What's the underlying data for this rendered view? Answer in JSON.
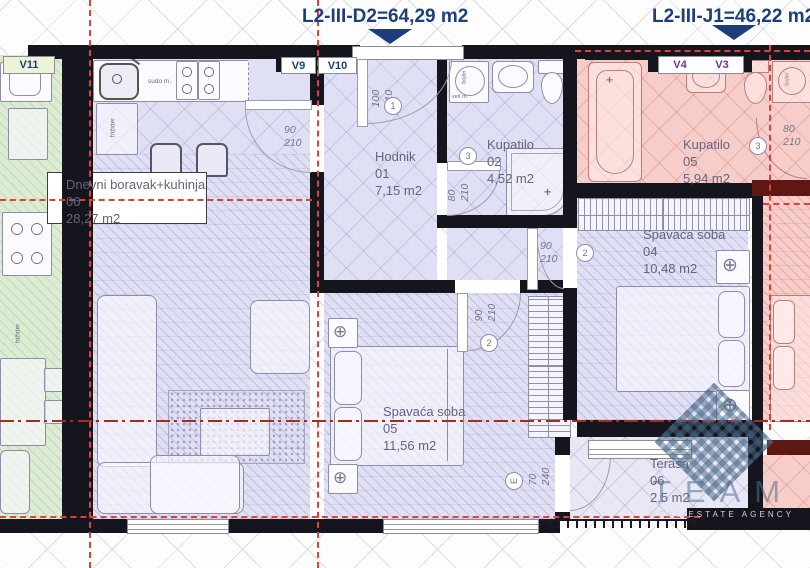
{
  "header": {
    "left_unit": "L2-III-D2=64,29 m2",
    "right_unit": "L2-III-J1=46,22 m2"
  },
  "vents": {
    "v11": "V11",
    "v9": "V9",
    "v10": "V10",
    "v4": "V4",
    "v3": "V3"
  },
  "rooms": {
    "living": {
      "name": "Dnevni boravak+kuhinja",
      "num": "06",
      "area": "28,27 m2"
    },
    "hallway": {
      "name": "Hodnik",
      "num": "01",
      "area": "7,15 m2"
    },
    "bath1": {
      "name": "Kupatilo",
      "num": "02",
      "area": "4,52 m2"
    },
    "bath2": {
      "name": "Kupatilo",
      "num": "05",
      "area": "5,94 m2"
    },
    "bedroom1": {
      "name": "Spavaća soba",
      "num": "04",
      "area": "10,48 m2"
    },
    "bedroom2": {
      "name": "Spavaća soba",
      "num": "05",
      "area": "11,56 m2"
    },
    "terrace": {
      "name": "Terasa",
      "num": "06",
      "area": "2,5 m2"
    }
  },
  "doors": {
    "entry": {
      "num": "1",
      "w": "100",
      "h": "210"
    },
    "living": {
      "w": "90",
      "h": "210"
    },
    "bath1": {
      "num": "3",
      "w": "80",
      "h": "210"
    },
    "bedroom1": {
      "num": "2",
      "w": "90",
      "h": "210"
    },
    "bedroom2": {
      "num": "2",
      "w": "90",
      "h": "210"
    },
    "bath2": {
      "num": "3",
      "w": "80",
      "h": "210"
    },
    "terrace": {
      "num": "E",
      "w": "70",
      "h": "240"
    }
  },
  "fixtures": {
    "sink_label": "sudo m.",
    "fridge_label": "frižider",
    "boiler_label": "bojler",
    "washer_label": "veš m."
  },
  "watermark": {
    "name": "TEAM",
    "tagline": "REAL ESTATE AGENCY"
  },
  "colors": {
    "wall": "#15151d",
    "navy": "#1c3f7c",
    "violet": "#7330a3",
    "red": "#e04038",
    "redDark": "#a62c22",
    "lav": "#e0e0f4",
    "pink": "#f6cdc8",
    "green": "#dcecd2",
    "maroon": "#5e1712"
  }
}
